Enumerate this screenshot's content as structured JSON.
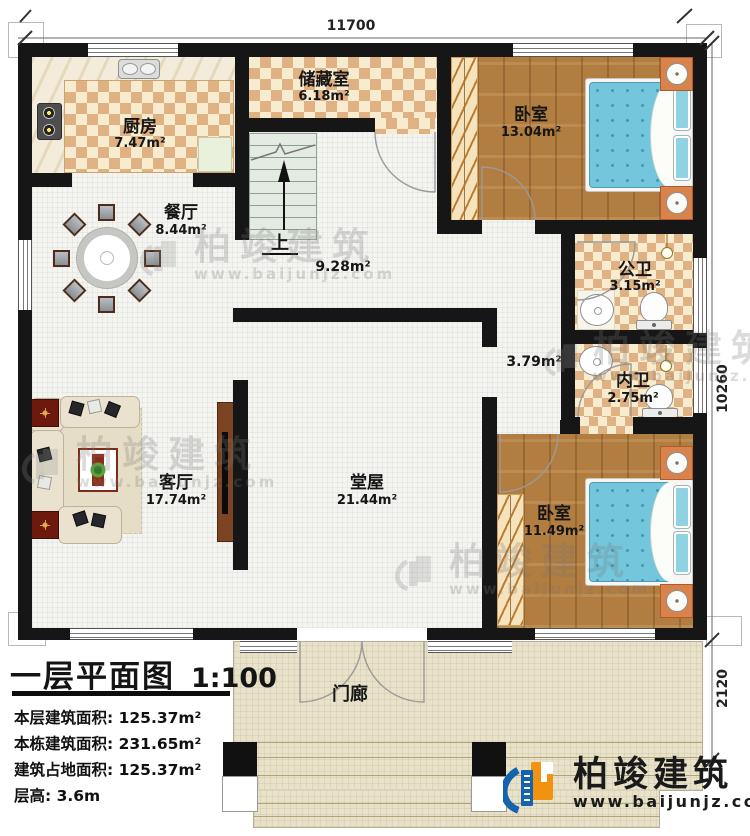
{
  "plan": {
    "dimensions": {
      "top": "11700",
      "right": "10260",
      "porch_depth": "2120"
    },
    "rooms": {
      "kitchen": {
        "name": "厨房",
        "area": "7.47m²"
      },
      "storage": {
        "name": "储藏室",
        "area": "6.18m²"
      },
      "bedroom_top": {
        "name": "卧室",
        "area": "13.04m²"
      },
      "dining": {
        "name": "餐厅",
        "area": "8.44m²"
      },
      "stair_hall": {
        "up": "上",
        "area": "9.28m²"
      },
      "bath_public": {
        "name": "公卫",
        "area": "3.15m²"
      },
      "corridor": {
        "area": "3.79m²"
      },
      "bath_inner": {
        "name": "内卫",
        "area": "2.75m²"
      },
      "living": {
        "name": "客厅",
        "area": "17.74m²"
      },
      "hall": {
        "name": "堂屋",
        "area": "21.44m²"
      },
      "bedroom_bottom": {
        "name": "卧室",
        "area": "11.49m²"
      },
      "porch": {
        "name": "门廊"
      }
    }
  },
  "title_block": {
    "title": "一层平面图",
    "scale": "1:100",
    "lines": [
      "本层建筑面积: 125.37m²",
      "本栋建筑面积: 231.65m²",
      "建筑占地面积: 125.37m²",
      "层高: 3.6m"
    ]
  },
  "brand": {
    "name": "柏竣建筑",
    "url": "www.baijunjz.com"
  },
  "watermark": {
    "name": "柏竣建筑",
    "url": "www.baijunjz.com"
  },
  "colors": {
    "wall": "#161616",
    "tile": "#f4f4f1",
    "chk_dark": "#e0b283",
    "chk_light": "#f8ecd0",
    "wood": "#b17d40",
    "porch": "#e9e2c8",
    "bed": "#74c6dc",
    "orange": "#d9834c",
    "logo_blue": "#1463ae",
    "logo_orange": "#f29211"
  }
}
